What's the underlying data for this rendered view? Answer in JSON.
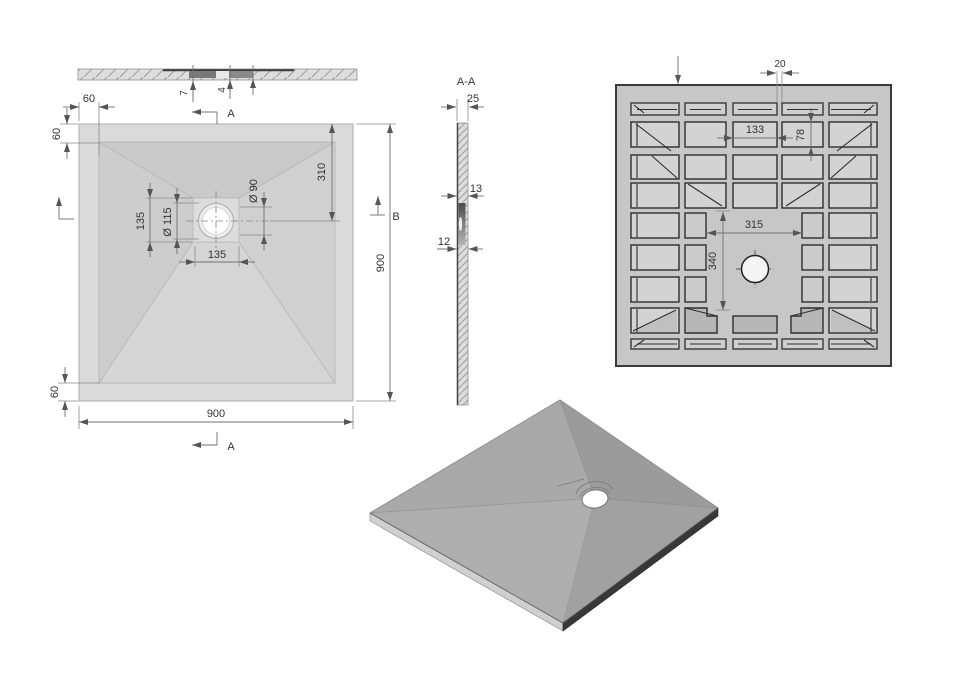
{
  "drawing_title": "Square shower tray technical drawing",
  "colors": {
    "outline_dark": "#2e2e2e",
    "dimension_line": "#707070",
    "tray_light_gray": "#d8d8d8",
    "tray_mid_gray": "#c7c7c7",
    "iso_gray": "#a4a4a4"
  },
  "views": {
    "edge": {
      "name": "front-edge-view",
      "dims": {
        "lip_height": "7",
        "recess_depth": "4"
      }
    },
    "plan": {
      "name": "top-plan-view",
      "section_arrow_top": "A",
      "section_arrow_bottom": "A",
      "section_arrow_right": "B",
      "dims": {
        "rim_top": "60",
        "rim_left": "60",
        "rim_bottom": "60",
        "drain_square_height": "135",
        "drain_square_width": "135",
        "drain_recess_dia": "Ø 115",
        "drain_hole_dia": "Ø 90",
        "drain_offset_from_top": "310",
        "overall_width": "900",
        "overall_height": "900"
      }
    },
    "section": {
      "label": "A-A",
      "dims": {
        "edge_thickness": "25",
        "mid_thickness": "13",
        "drain_thickness": "12"
      }
    },
    "underside": {
      "name": "bottom-rib-view",
      "dims": {
        "rib_width": "20",
        "pocket_width": "133",
        "pocket_height": "78",
        "center_width": "315",
        "center_height": "340"
      }
    },
    "iso": {
      "name": "isometric-view"
    }
  }
}
